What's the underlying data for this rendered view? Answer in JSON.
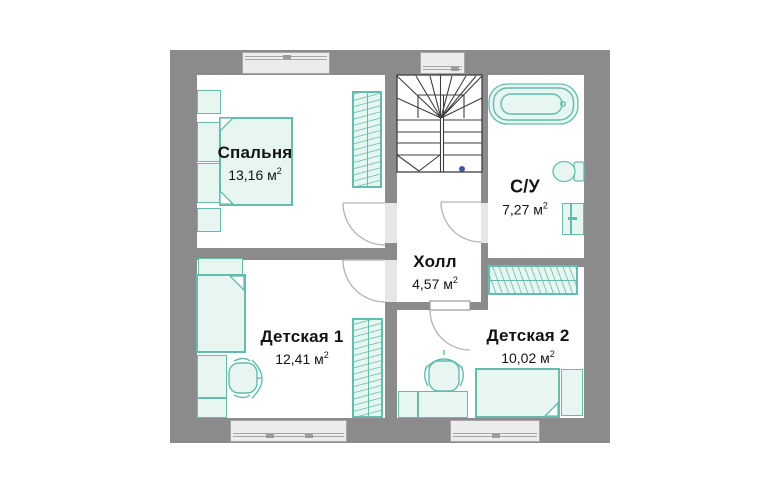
{
  "theme": {
    "wall_color": "#8b8b8b",
    "window_fill": "#ececec",
    "window_line": "#a6a6a6",
    "furniture_stroke": "#63bcae",
    "furniture_fill": "#e8f6f1",
    "hatch_line": "#7fcabd",
    "stair_line": "#3e3e3e",
    "door_line": "#b3b3b3",
    "doorway_fill": "#e6e6e6",
    "text_color": "#141414",
    "dot_color": "#46549c",
    "background": "#ffffff"
  },
  "unit": {
    "symbol": "м",
    "sup": "2"
  },
  "rooms": [
    {
      "name": "Спальня",
      "area": "13,16"
    },
    {
      "name": "С/У",
      "area": "7,27"
    },
    {
      "name": "Холл",
      "area": "4,57"
    },
    {
      "name": "Детская 1",
      "area": "12,41"
    },
    {
      "name": "Детская 2",
      "area": "10,02"
    }
  ]
}
